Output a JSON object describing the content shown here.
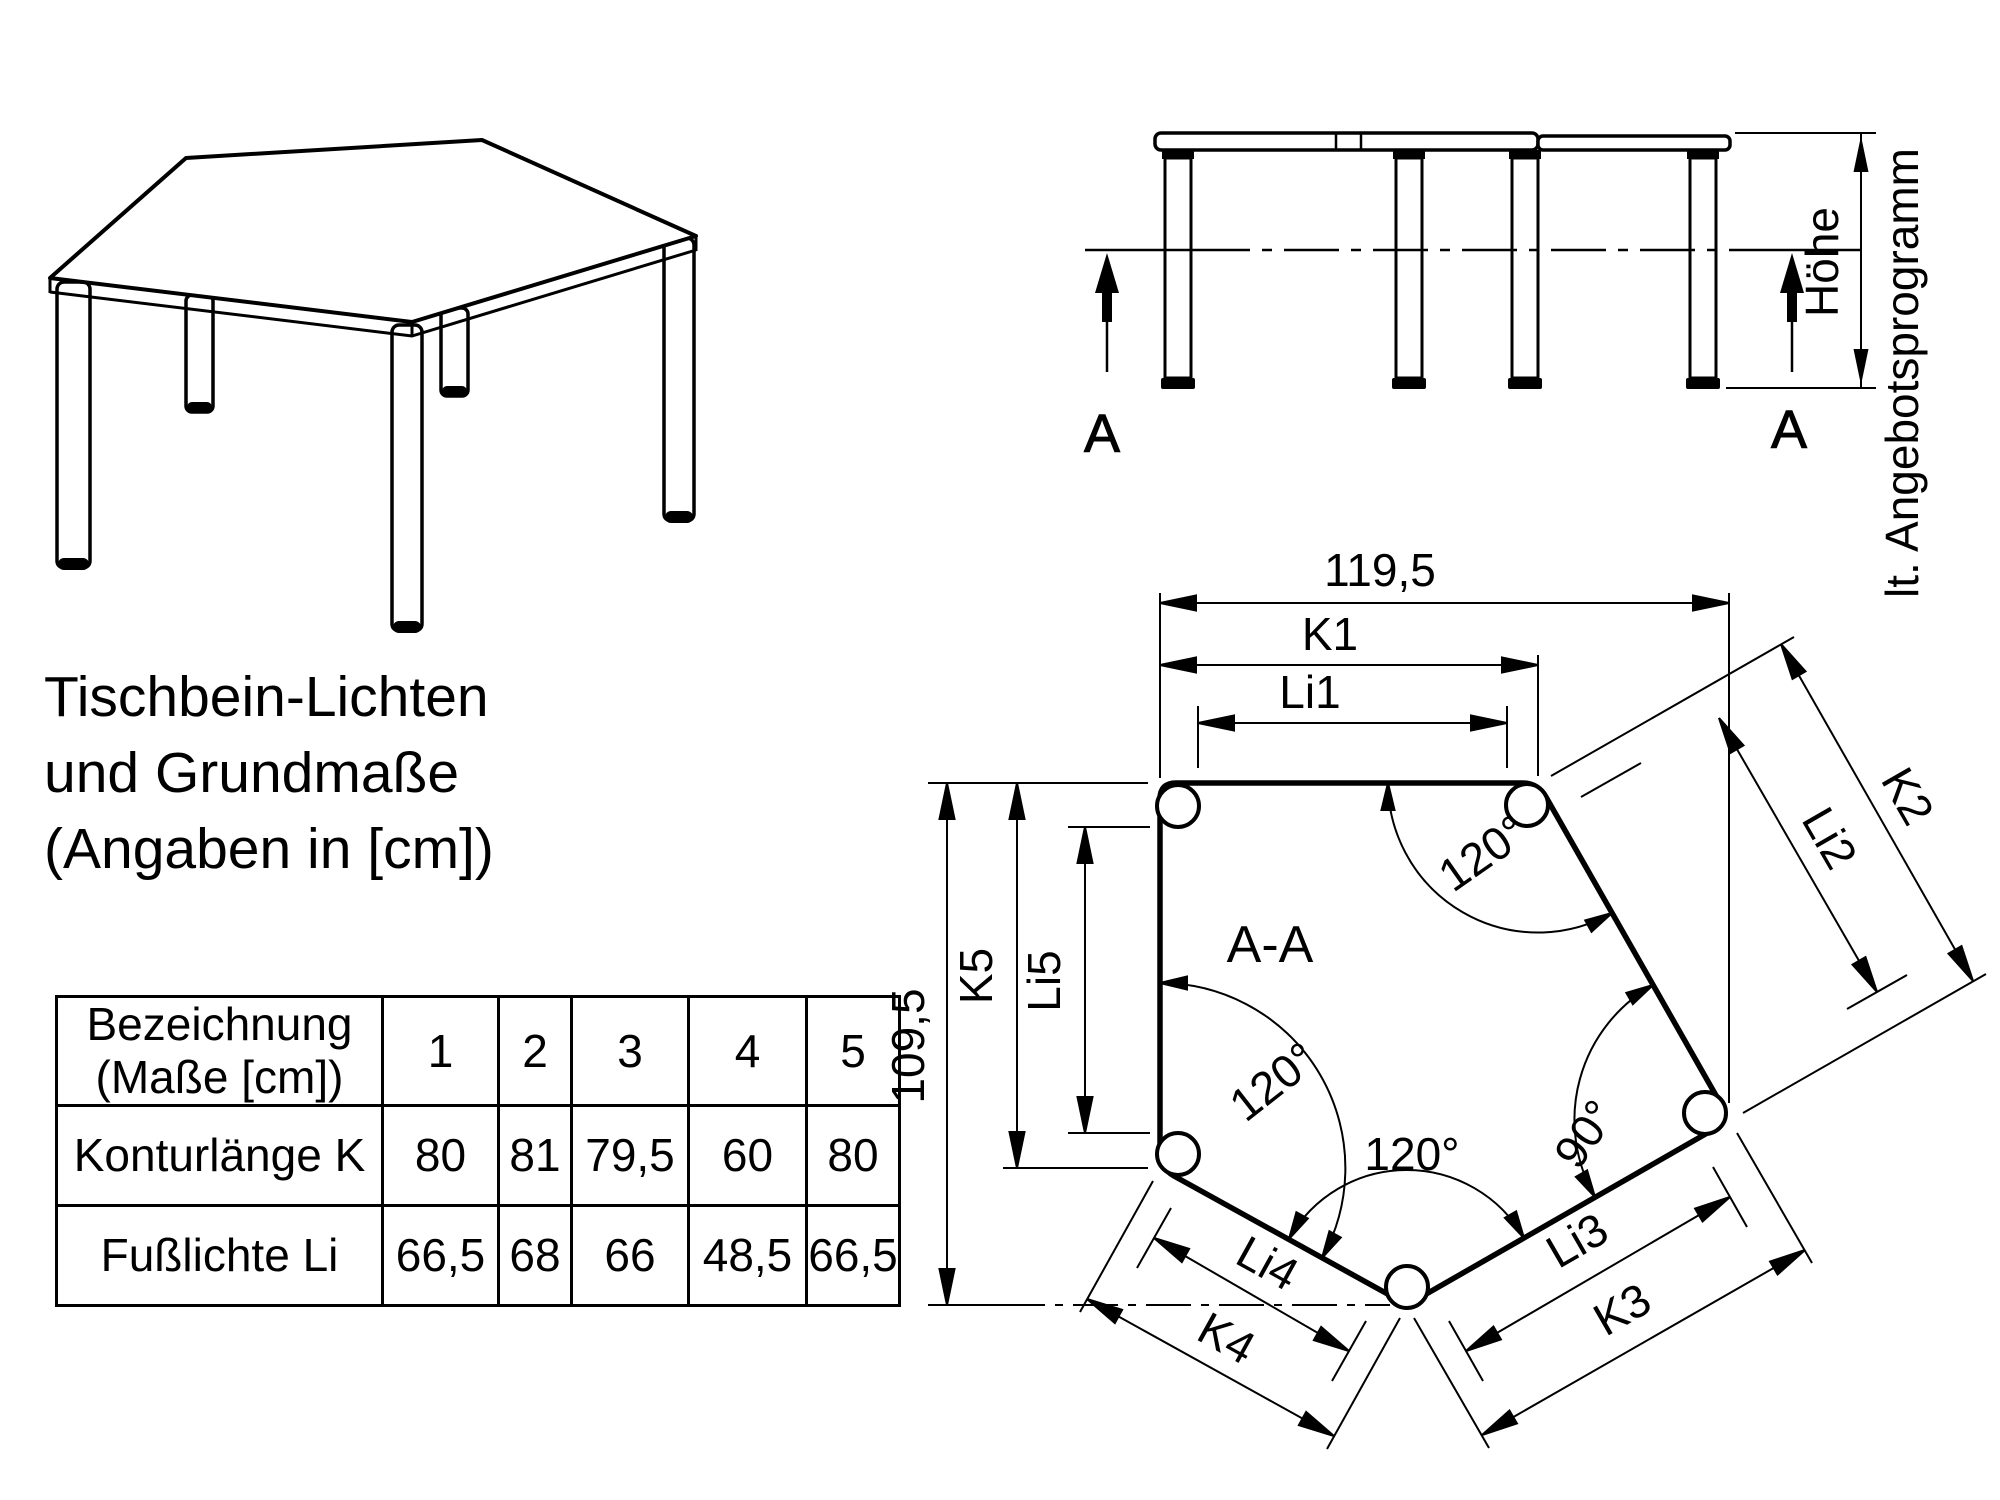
{
  "page": {
    "background": "#ffffff",
    "ink": "#000000"
  },
  "title": {
    "line1": "Tischbein-Lichten",
    "line2": "und Grundmaße",
    "line3": "(Angaben in [cm])"
  },
  "elevation": {
    "section_arrow_left": "A",
    "section_arrow_right": "A",
    "height_label": "Höhe",
    "height_note": "lt. Angebotsprogramm"
  },
  "plan": {
    "section_title": "A-A",
    "dims": {
      "overall_width": "119,5",
      "overall_height": "109,5",
      "k1": "K1",
      "li1": "Li1",
      "k2": "K2",
      "li2": "Li2",
      "k3": "K3",
      "li3": "Li3",
      "k4": "K4",
      "li4": "Li4",
      "k5": "K5",
      "li5": "Li5"
    },
    "angles": {
      "top_right": "120°",
      "left": "120°",
      "bottom": "120°",
      "right": "90°"
    }
  },
  "table": {
    "header_label_line1": "Bezeichnung",
    "header_label_line2": "(Maße [cm])",
    "columns": [
      "1",
      "2",
      "3",
      "4",
      "5"
    ],
    "rows": [
      {
        "label": "Konturlänge K",
        "values": [
          "80",
          "81",
          "79,5",
          "60",
          "80"
        ]
      },
      {
        "label": "Fußlichte Li",
        "values": [
          "66,5",
          "68",
          "66",
          "48,5",
          "66,5"
        ]
      }
    ]
  }
}
